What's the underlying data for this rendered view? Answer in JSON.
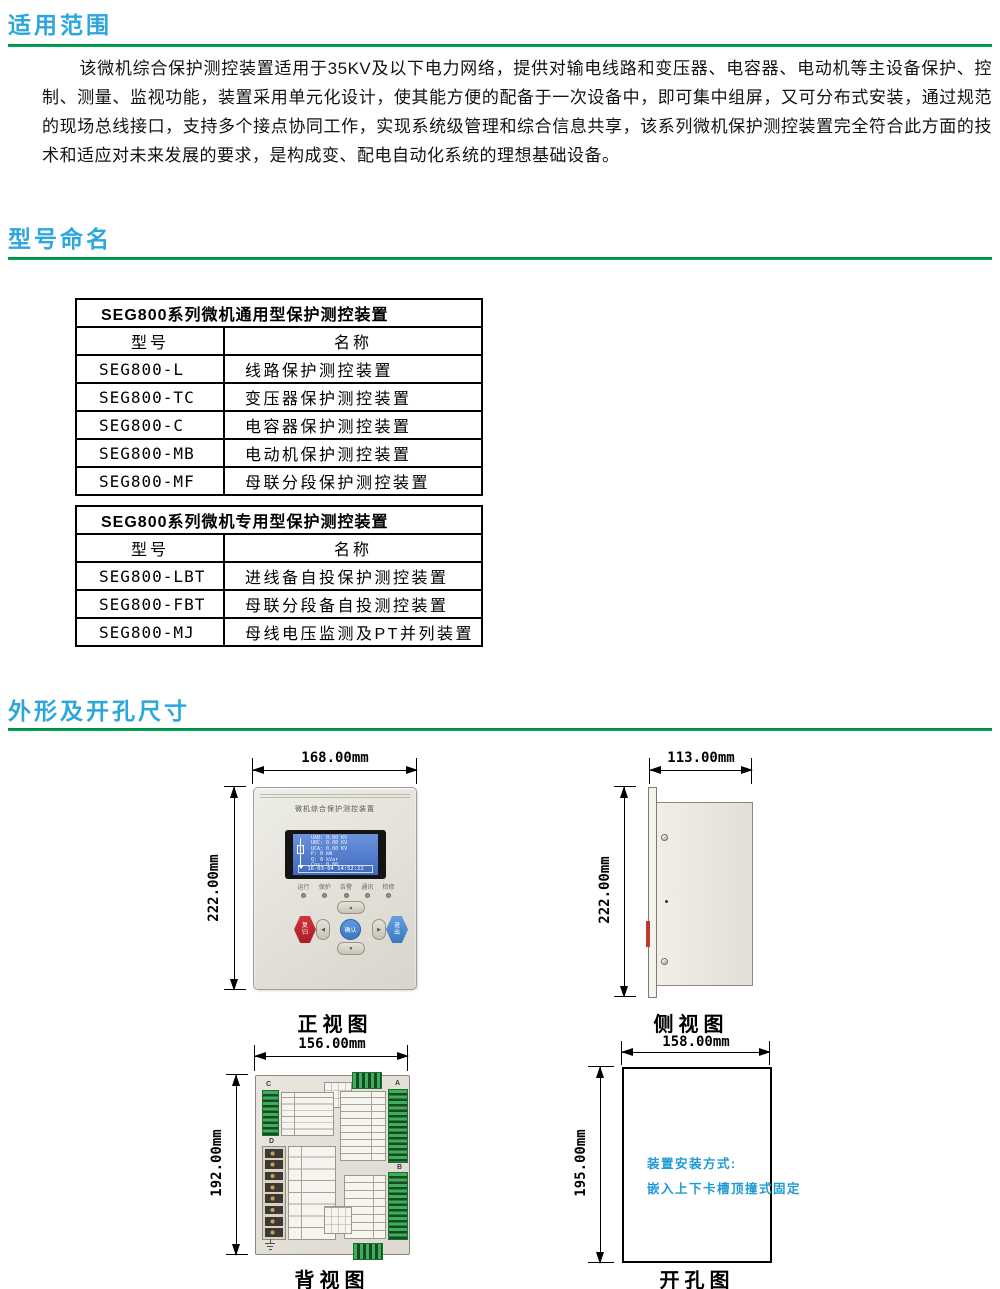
{
  "sections": {
    "scope": {
      "heading": "适用范围",
      "body": "该微机综合保护测控装置适用于35KV及以下电力网络，提供对输电线路和变压器、电容器、电动机等主设备保护、控制、测量、监视功能，装置采用单元化设计，使其能方便的配备于一次设备中，即可集中组屏，又可分布式安装，通过规范的现场总线接口，支持多个接点协同工作，实现系统级管理和综合信息共享，该系列微机保护测控装置完全符合此方面的技术和适应对未来发展的要求，是构成变、配电自动化系统的理想基础设备。"
    },
    "naming": {
      "heading": "型号命名",
      "tables": [
        {
          "title": "SEG800系列微机通用型保护测控装置",
          "columns": [
            "型号",
            "名称"
          ],
          "rows": [
            [
              "SEG800-L",
              "线路保护测控装置"
            ],
            [
              "SEG800-TC",
              "变压器保护测控装置"
            ],
            [
              "SEG800-C",
              "电容器保护测控装置"
            ],
            [
              "SEG800-MB",
              "电动机保护测控装置"
            ],
            [
              "SEG800-MF",
              "母联分段保护测控装置"
            ]
          ]
        },
        {
          "title": "SEG800系列微机专用型保护测控装置",
          "columns": [
            "型号",
            "名称"
          ],
          "rows": [
            [
              "SEG800-LBT",
              "进线备自投保护测控装置"
            ],
            [
              "SEG800-FBT",
              "母联分段备自投测控装置"
            ],
            [
              "SEG800-MJ",
              "母线电压监测及PT并列装置"
            ]
          ]
        }
      ]
    },
    "dimensions": {
      "heading": "外形及开孔尺寸",
      "front": {
        "caption": "正视图",
        "width": "168.00mm",
        "height": "222.00mm",
        "panel_title": "微机综合保护测控装置",
        "lcd": {
          "lines": [
            "UAB: 0.00 KV",
            "UBC: 0.00 KV",
            "UCA: 0.00 KV",
            "P:      0 kW",
            "Q:    0 kVar",
            "Cos:  0.00"
          ],
          "datetime": "16-03-04  14:52:22"
        },
        "leds": [
          "运行",
          "保护",
          "告警",
          "通讯",
          "检修"
        ],
        "buttons": {
          "reset": "复归",
          "confirm": "确认",
          "exit": "退出"
        },
        "dpad": {
          "up": "▲",
          "down": "▼",
          "left": "◀",
          "right": "▶"
        }
      },
      "side": {
        "caption": "侧视图",
        "width": "113.00mm",
        "height": "222.00mm"
      },
      "back": {
        "caption": "背视图",
        "width": "156.00mm",
        "height": "192.00mm",
        "connector_labels": [
          "C",
          "D",
          "A",
          "B"
        ]
      },
      "cutout": {
        "caption": "开孔图",
        "width": "158.00mm",
        "height": "195.00mm",
        "note": [
          "装置安装方式:",
          "嵌入上下卡槽顶撞式固定"
        ]
      }
    }
  },
  "colors": {
    "heading_blue": "#2BA7DE",
    "rule_green": "#00A653",
    "note_blue": "#1E9AD6",
    "panel_beige": "#E2DFD7",
    "lcd_blue": "#4C7FD0",
    "terminal_green": "#3FAE5A",
    "button_red": "#C4242B",
    "button_blue": "#4A8FD5"
  }
}
